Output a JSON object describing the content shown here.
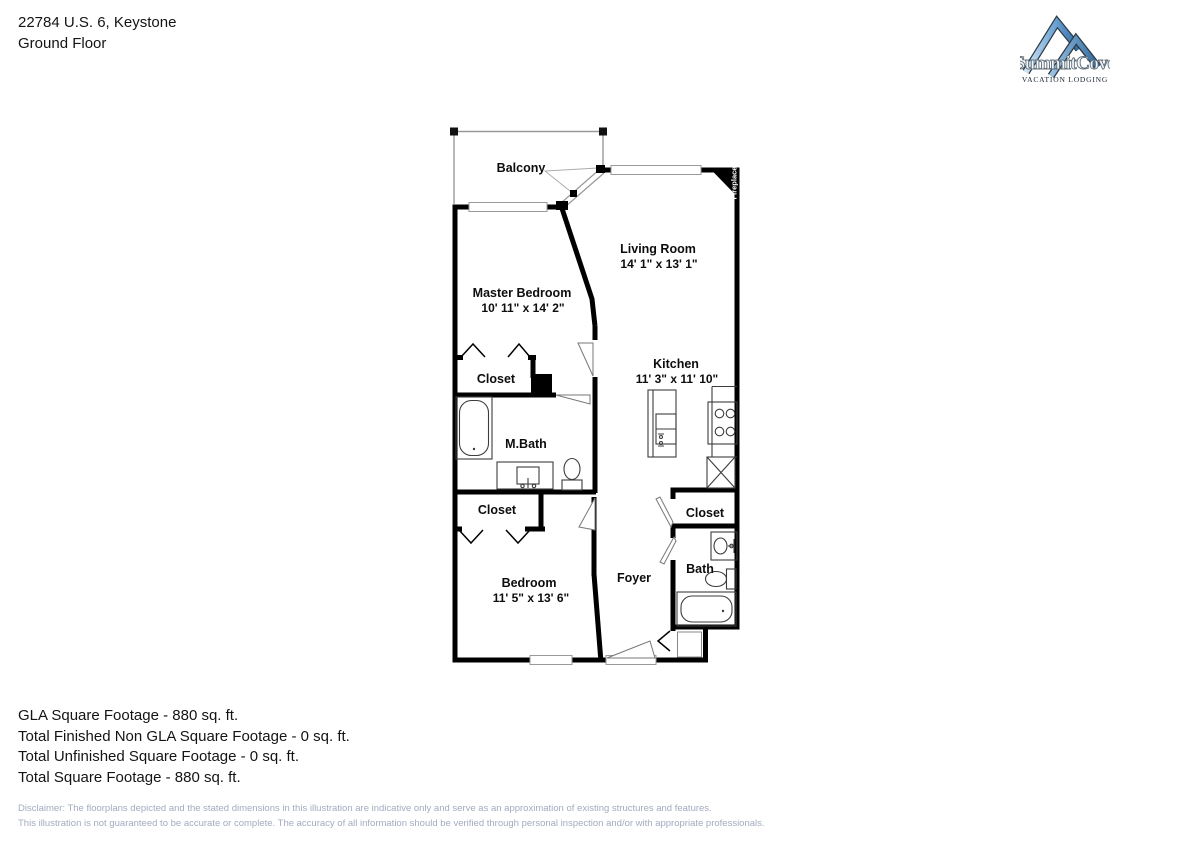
{
  "header": {
    "address": "22784 U.S. 6, Keystone",
    "floor_label": "Ground Floor"
  },
  "logo": {
    "brand": "SummitCove",
    "tagline": "VACATION LODGING",
    "colors": {
      "mountain_light": "#cfe3f2",
      "mountain_mid": "#6ba2d4",
      "mountain_dark": "#2f6aa0",
      "outline": "#2c3a47",
      "tagline_text": "#1a2531"
    }
  },
  "floorplan": {
    "rooms": [
      {
        "id": "balcony",
        "label": "Balcony"
      },
      {
        "id": "living-room",
        "label": "Living Room",
        "dims": "14' 1\" x 13' 1\""
      },
      {
        "id": "master-bedroom",
        "label": "Master Bedroom",
        "dims": "10' 11\" x 14' 2\""
      },
      {
        "id": "master-closet",
        "label": "Closet"
      },
      {
        "id": "master-bath",
        "label": "M.Bath"
      },
      {
        "id": "kitchen",
        "label": "Kitchen",
        "dims": "11' 3\" x 11' 10\""
      },
      {
        "id": "bedroom-closet",
        "label": "Closet"
      },
      {
        "id": "bedroom",
        "label": "Bedroom",
        "dims": "11' 5\" x 13' 6\""
      },
      {
        "id": "foyer",
        "label": "Foyer"
      },
      {
        "id": "hall-closet",
        "label": "Closet"
      },
      {
        "id": "bath",
        "label": "Bath"
      },
      {
        "id": "fireplace",
        "label": "Fireplace"
      }
    ],
    "wall_color": "#000000",
    "fixture_color": "#3c3c3c"
  },
  "summary": {
    "lines": [
      "GLA Square Footage - 880 sq. ft.",
      "Total Finished Non GLA Square Footage - 0 sq. ft.",
      "Total Unfinished Square Footage - 0 sq. ft.",
      "Total Square Footage - 880 sq. ft."
    ]
  },
  "disclaimer": {
    "line1": "Disclaimer: The floorplans depicted and the stated dimensions in this illustration are indicative only and serve as an approximation of existing structures and features.",
    "line2": "This illustration is not guaranteed to be accurate or complete. The accuracy of all information should be verified through personal inspection and/or with appropriate professionals.",
    "text_color": "#a3abbf"
  }
}
